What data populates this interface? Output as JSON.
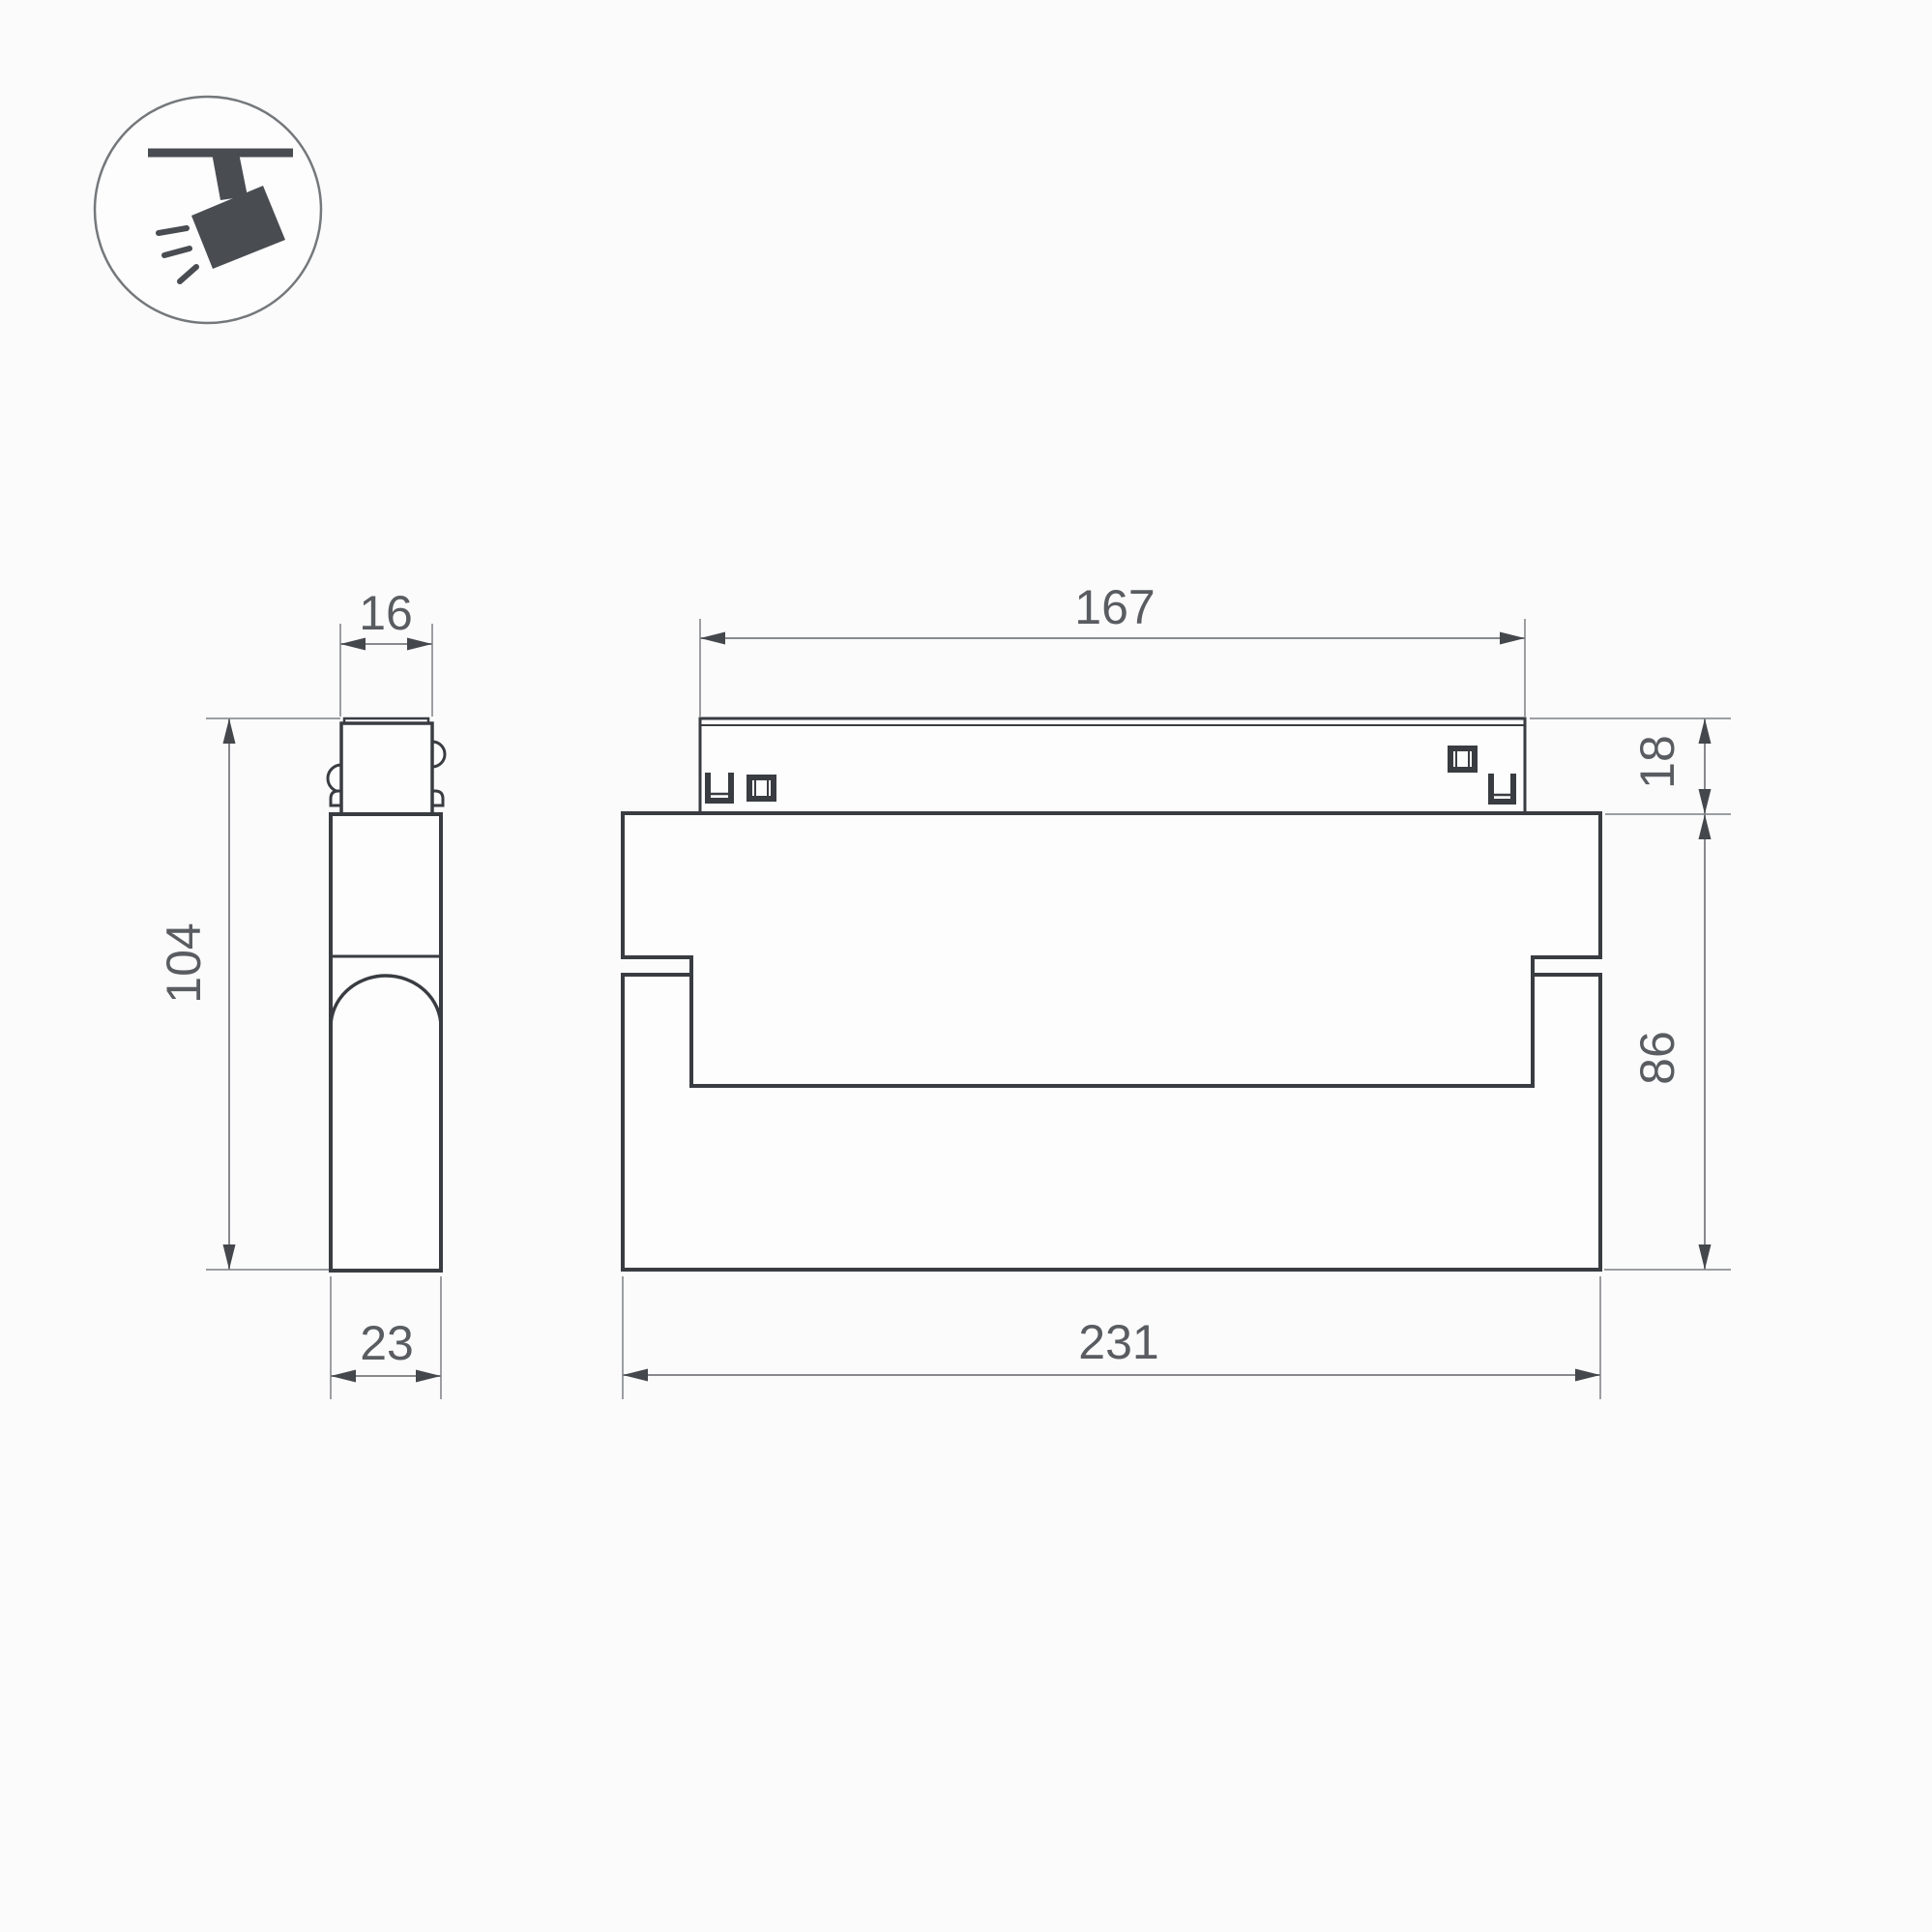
{
  "icon": {
    "type": "ceiling-track-spotlight-icon"
  },
  "dimensions": {
    "side_top_width": "16",
    "side_height": "104",
    "side_bottom_width": "23",
    "front_top_width": "167",
    "front_track_height": "18",
    "front_body_height": "86",
    "front_total_width": "231"
  },
  "colors": {
    "background": "#fbfbfc",
    "outline": "#393c41",
    "dimension_line": "#87898c",
    "extension_line": "#9c9ea1",
    "arrow": "#44474b",
    "label_text": "#595c60",
    "icon_dark": "#494d52",
    "icon_circle": "#75787b"
  }
}
